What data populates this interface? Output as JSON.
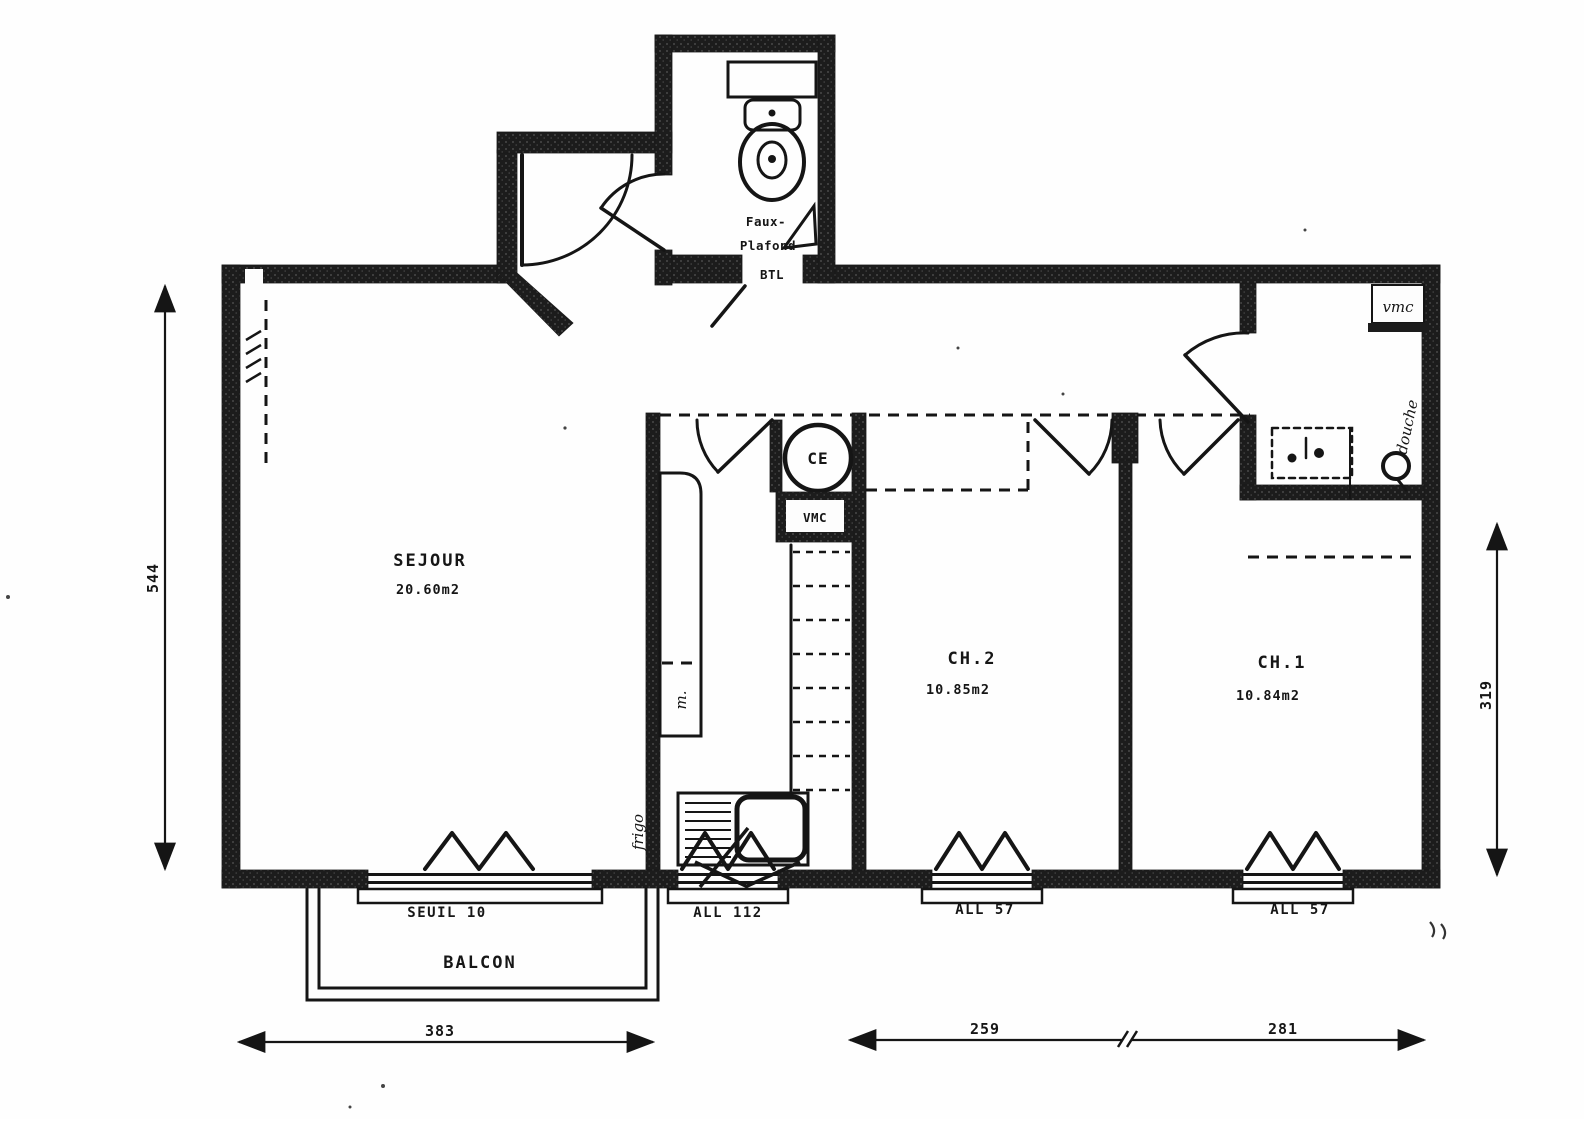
{
  "title": "apartment-floor-plan",
  "rooms": {
    "sejour": {
      "name": "SEJOUR",
      "area": "20.60m2"
    },
    "ch2": {
      "name": "CH.2",
      "area": "10.85m2"
    },
    "ch1": {
      "name": "CH.1",
      "area": "10.84m2"
    },
    "balcony": {
      "name": "BALCON"
    },
    "wc": {
      "note_line1": "Faux-",
      "note_line2": "Plafond",
      "duct_label": "BTL"
    }
  },
  "equipment": {
    "water_heater": "CE",
    "kitchen_vent": "VMC",
    "bath_vent": "vmc",
    "shower_note": "douche",
    "fridge_note": "frigo",
    "washer_note": "m."
  },
  "openings": {
    "sill_balcony_door": "SEUIL 10",
    "window_kitchen": "ALL 112",
    "window_ch2": "ALL 57",
    "window_ch1": "ALL 57"
  },
  "dimensions": {
    "left_height": "544",
    "right_height": "319",
    "bottom_living": "383",
    "bottom_ch2": "259",
    "bottom_ch1": "281"
  },
  "colors": {
    "ink": "#151515",
    "paper": "#fefefe"
  }
}
